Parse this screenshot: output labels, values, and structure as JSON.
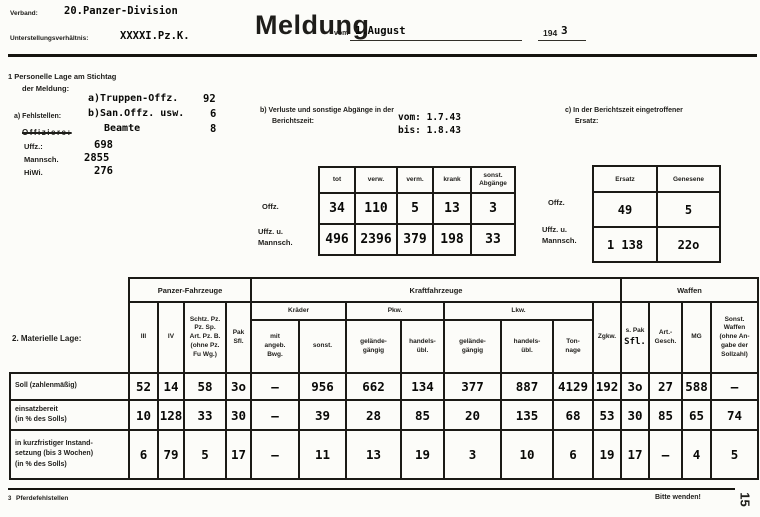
{
  "colors": {
    "paper": "#fcfcf9",
    "ink": "#1b1a16"
  },
  "header": {
    "verband_label": "Verband:",
    "verband_value": "20.Panzer-Division",
    "unterstellung_label": "Unterstellungsverhältnis:",
    "unterstellung_value": "XXXXI.Pz.K.",
    "title": "Meldung",
    "vom_label": "vom",
    "date_value": "1.August",
    "year_prefix": "194",
    "year_suffix": "3"
  },
  "personnel": {
    "heading_line1": "1  Personelle Lage am Stichtag",
    "heading_line2": "der Meldung:",
    "fehlstellen_label": "a) Fehlstellen:",
    "entry_a_label": "a)Truppen-Offz.",
    "entry_a_value": "92",
    "entry_b_label": "b)San.Offz. usw.",
    "entry_b_value": "6",
    "entry_c_label": "Beamte",
    "entry_c_value": "8",
    "struck_label": "Offiziere:",
    "uffz_label": "Uffz.:",
    "uffz_value": "698",
    "mannsch_label": "Mannsch.",
    "mannsch_value": "2855",
    "hiwi_label": "HiWi.",
    "hiwi_value": "276"
  },
  "losses": {
    "heading_line1": "b) Verluste und sonstige Abgänge in der",
    "heading_line2": "Berichtszeit:",
    "vom": "vom: 1.7.43",
    "bis": "bis: 1.8.43",
    "columns": [
      "tot",
      "verw.",
      "verm.",
      "krank",
      "sonst.\nAbgänge"
    ],
    "row1_label": "Offz.",
    "row2_label": "Uffz. u.\nMannsch.",
    "rows": [
      [
        "34",
        "110",
        "5",
        "13",
        "3"
      ],
      [
        "496",
        "2396",
        "379",
        "198",
        "33"
      ]
    ]
  },
  "ersatz": {
    "heading_line1": "c) In der Berichtszeit eingetroffener",
    "heading_line2": "Ersatz:",
    "columns": [
      "Ersatz",
      "Genesene"
    ],
    "row1_label": "Offz.",
    "row2_label": "Uffz. u.\nMannsch.",
    "rows": [
      [
        "49",
        "5"
      ],
      [
        "1 138",
        "22o"
      ]
    ]
  },
  "material": {
    "label": "2. Materielle Lage:",
    "groups": {
      "panzer": "Panzer-Fahrzeuge",
      "kfz": "Kraftfahrzeuge",
      "waffen": "Waffen"
    },
    "cols": {
      "iii": "III",
      "iv": "IV",
      "schtz": "Schtz. Pz.\nPz. Sp.\nArt. Pz. B.\n(ohne Pz.\nFu Wg.)",
      "pak": "Pak\nSfl.",
      "kraeder": "Kräder",
      "pkw": "Pkw.",
      "lkw": "Lkw.",
      "kraeder_mit": "mit\nangeb.\nBwg.",
      "kraeder_sonst": "sonst.",
      "gelaende": "gelände-\ngängig",
      "handels": "handels-\nübl.",
      "tonnage": "Ton-\nnage",
      "zgkw": "Zgkw.",
      "spak_print": "s. Pak",
      "spak_typed": "Sfl.",
      "art": "Art.-\nGesch.",
      "mg": "MG",
      "sonst_waffen": "Sonst.\nWaffen\n(ohne An-\ngabe der\nSollzahl)"
    },
    "rows": [
      {
        "label": "Soll (zahlenmäßig)",
        "values": [
          "52",
          "14",
          "58",
          "3o",
          "–",
          "956",
          "662",
          "134",
          "377",
          "887",
          "4129",
          "192",
          "3o",
          "27",
          "588",
          "–"
        ]
      },
      {
        "label": "einsatzbereit\n(in % des Solls)",
        "values": [
          "10",
          "128",
          "33",
          "30",
          "–",
          "39",
          "28",
          "85",
          "20",
          "135",
          "68",
          "53",
          "30",
          "85",
          "65",
          "74"
        ]
      },
      {
        "label": "in kurzfristiger Instand-\nsetzung (bis 3 Wochen)\n(in % des Solls)",
        "values": [
          "6",
          "79",
          "5",
          "17",
          "–",
          "11",
          "13",
          "19",
          "3",
          "10",
          "6",
          "19",
          "17",
          "–",
          "4",
          "5"
        ]
      }
    ]
  },
  "footer": {
    "footnote_marker": "3",
    "footnote": "Pferdefehlstellen",
    "turn_note": "Bitte wenden!",
    "page_number": "15"
  }
}
